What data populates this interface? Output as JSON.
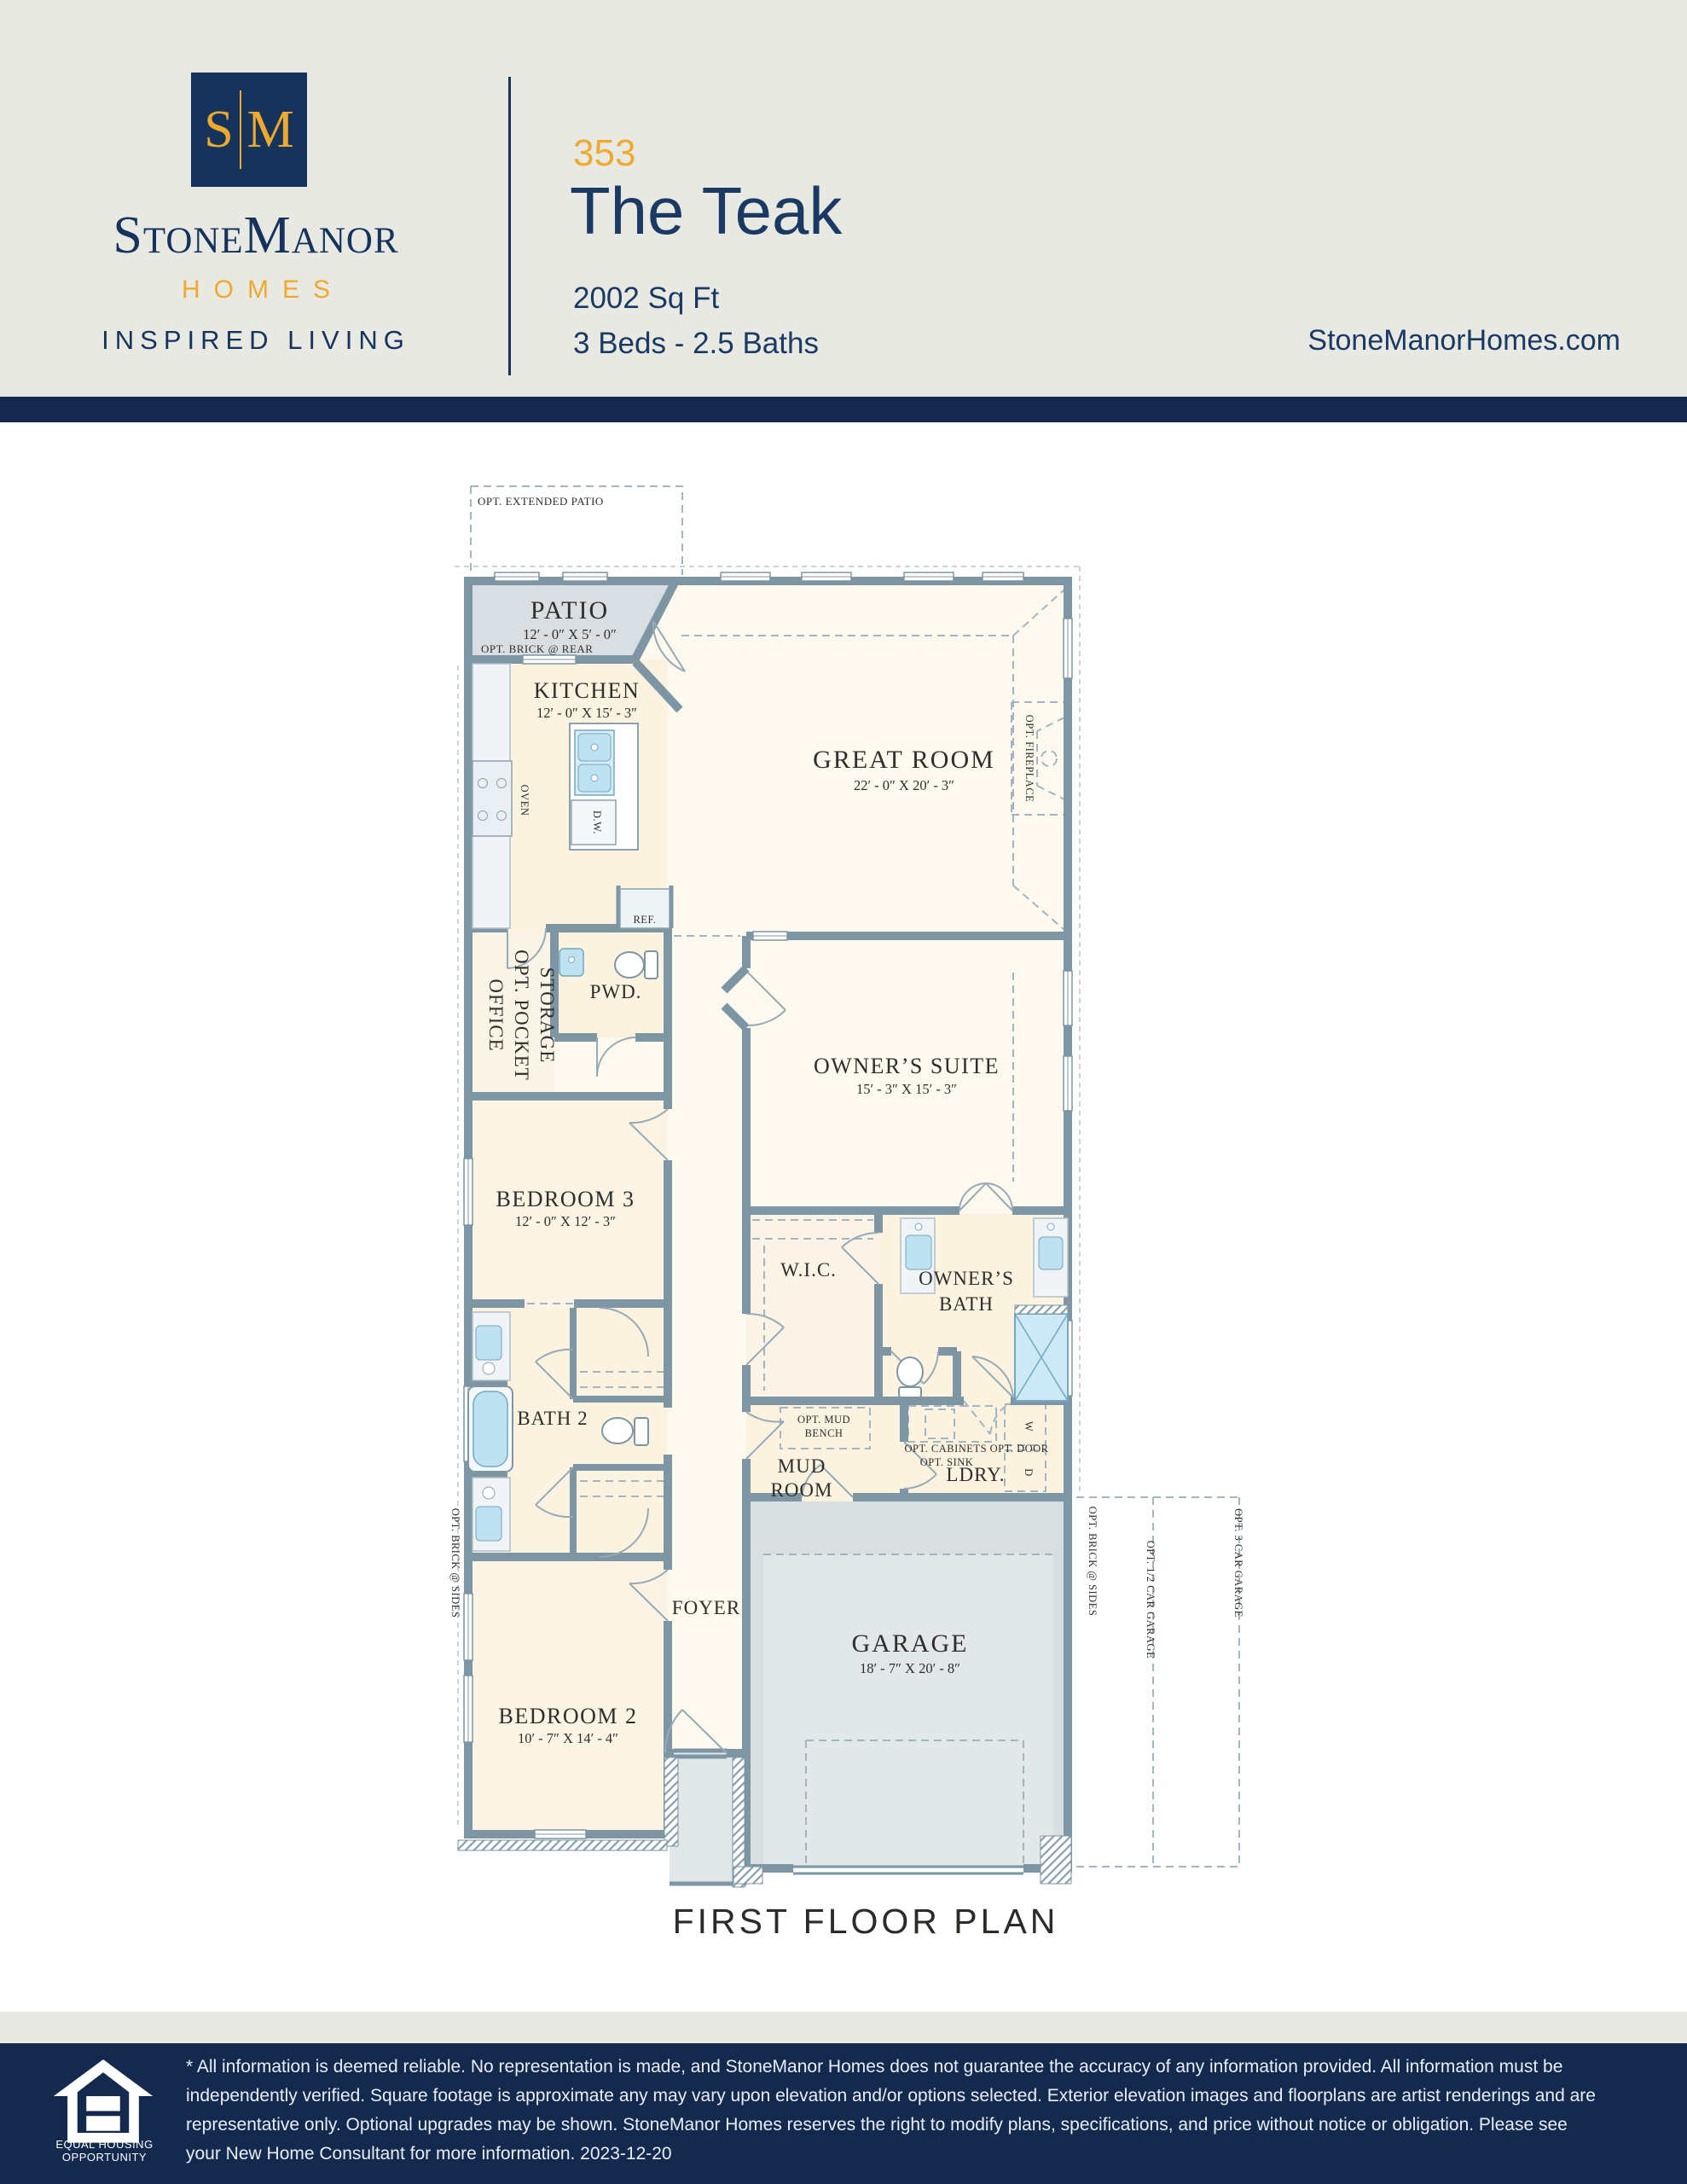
{
  "header": {
    "logo": {
      "monogram_left": "S",
      "monogram_right": "M",
      "name": "StoneManor",
      "homes": "HOMES",
      "tagline": "INSPIRED LIVING"
    },
    "plan_number": "353",
    "plan_name": "The Teak",
    "sqft": "2002 Sq Ft",
    "beds_baths": "3 Beds - 2.5 Baths",
    "website": "StoneManorHomes.com"
  },
  "plan": {
    "title": "FIRST FLOOR PLAN",
    "labels": {
      "opt_extended_patio": "OPT. EXTENDED PATIO",
      "patio": "PATIO",
      "patio_dims": "12′ - 0″ X 5′ - 0″",
      "opt_brick_rear": "OPT. BRICK @ REAR",
      "kitchen": "KITCHEN",
      "kitchen_dims": "12′ - 0″ X 15′ - 3″",
      "oven": "OVEN",
      "dw": "D.W.",
      "ref": "REF.",
      "great_room": "GREAT ROOM",
      "great_room_dims": "22′ - 0″ X 20′ - 3″",
      "opt_fireplace": "OPT. FIREPLACE",
      "storage": "STORAGE",
      "opt_pocket": "OPT. POCKET",
      "office": "OFFICE",
      "pwd": "PWD.",
      "owners_suite": "OWNER’S SUITE",
      "owners_suite_dims": "15′ - 3″ X 15′ - 3″",
      "bedroom3": "BEDROOM 3",
      "bedroom3_dims": "12′ - 0″ X 12′ - 3″",
      "wic": "W.I.C.",
      "owners": "OWNER’S",
      "bath": "BATH",
      "bath2": "BATH 2",
      "opt_mud": "OPT. MUD",
      "bench": "BENCH",
      "mud": "MUD",
      "room": "ROOM",
      "opt_cabinets_door": "OPT. CABINETS  OPT. DOOR",
      "opt_sink": "OPT. SINK",
      "ldry": "LDRY.",
      "w": "W",
      "d": "D",
      "foyer": "FOYER",
      "bedroom2": "BEDROOM 2",
      "bedroom2_dims": "10′ - 7″ X 14′ - 4″",
      "garage": "GARAGE",
      "garage_dims": "18′ - 7″ X 20′ - 8″",
      "opt_brick_sides": "OPT. BRICK @ SIDES",
      "opt_half_car": "OPT. 1/2 CAR GARAGE",
      "opt_3car": "OPT. 3 CAR GARAGE"
    }
  },
  "footer": {
    "eho_line1": "EQUAL HOUSING",
    "eho_line2": "OPPORTUNITY",
    "disclaimer": "* All information is deemed reliable. No representation is made, and StoneManor Homes does not guarantee the accuracy of any information provided. All information must be independently verified. Square footage is approximate any may vary upon elevation and/or options selected. Exterior elevation images and floorplans are artist renderings and are representative only. Optional upgrades may be shown. StoneManor Homes reserves the right to modify plans, specifications, and price without notice or obligation. Please see your New Home Consultant for more information. 2023-12-20"
  },
  "colors": {
    "navy": "#14294e",
    "gold": "#edaa2f",
    "wall": "#7e96a3",
    "cream": "#fbf2e0",
    "gray_fill": "#d9dfe1"
  }
}
